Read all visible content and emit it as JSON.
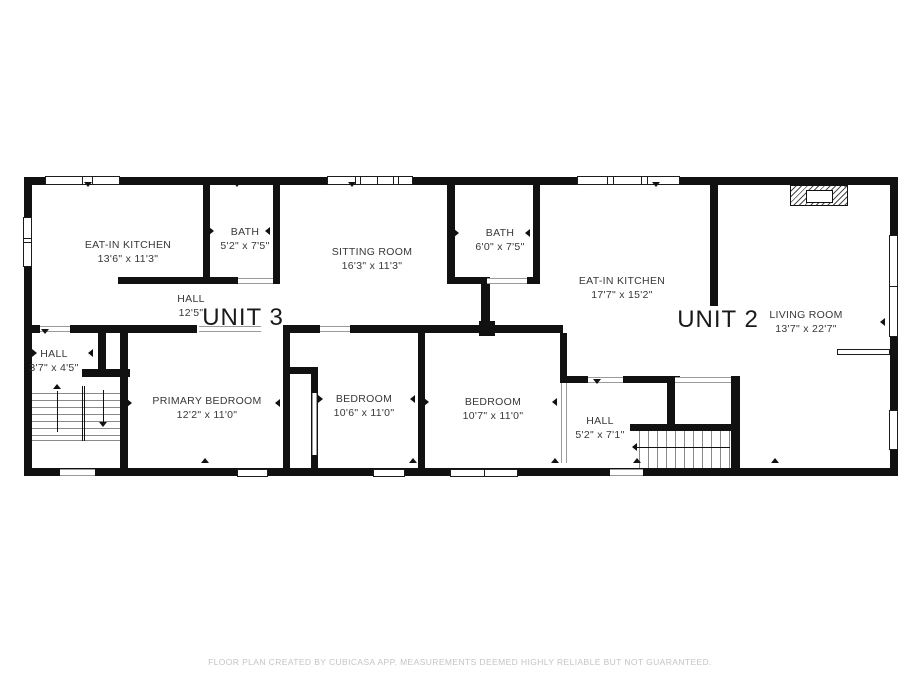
{
  "units": [
    {
      "label": "UNIT 3"
    },
    {
      "label": "UNIT 2"
    }
  ],
  "rooms": [
    {
      "name": "EAT-IN KITCHEN",
      "dims": "13'6\" x 11'3\""
    },
    {
      "name": "BATH",
      "dims": "5'2\" x 7'5\""
    },
    {
      "name": "SITTING ROOM",
      "dims": "16'3\" x 11'3\""
    },
    {
      "name": "BATH",
      "dims": "6'0\" x 7'5\""
    },
    {
      "name": "EAT-IN KITCHEN",
      "dims": "17'7\" x 15'2\""
    },
    {
      "name": "LIVING ROOM",
      "dims": "13'7\" x 22'7\""
    },
    {
      "name": "HALL",
      "dims": "12'5\""
    },
    {
      "name": "HALL",
      "dims": "3'7\" x 4'5\""
    },
    {
      "name": "PRIMARY BEDROOM",
      "dims": "12'2\" x 11'0\""
    },
    {
      "name": "BEDROOM",
      "dims": "10'6\" x 11'0\""
    },
    {
      "name": "BEDROOM",
      "dims": "10'7\" x 11'0\""
    },
    {
      "name": "HALL",
      "dims": "5'2\" x 7'1\""
    }
  ],
  "footer": {
    "disclaimer": "FLOOR PLAN CREATED BY CUBICASA APP. MEASUREMENTS DEEMED HIGHLY RELIABLE BUT NOT GUARANTEED."
  },
  "colors": {
    "wall": "#111111",
    "room_label": "#383838",
    "unit_label": "#1a1a1a",
    "disclaimer": "#c4c4c4",
    "background": "#ffffff"
  }
}
